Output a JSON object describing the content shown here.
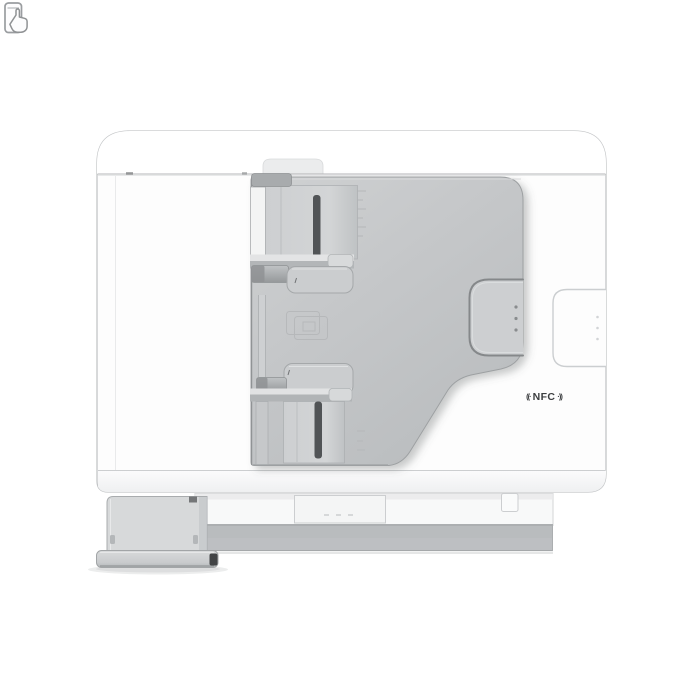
{
  "meta": {
    "description": "Product photo: white multifunction printer seen from above/rear, with gray automatic document feeder, paper guide rails, NFC tap zone, output tray and left hinge foot",
    "background": "#ffffff"
  },
  "labels": {
    "nfc_wave_left": "((·",
    "nfc": "NFC",
    "nfc_wave_right": "·))"
  },
  "icons": {
    "nfc_phone_tap": "smartphone outline with tapping hand",
    "paper_emboss": "embossed overlapping-pages glyph on ADF panel"
  },
  "colors": {
    "background": "#ffffff",
    "body": "#fdfdfd",
    "body_outline": "#c3c5c7",
    "adf_panel_edge": "#9da0a2",
    "slot_dark": "#515456",
    "tab": "#a8abad",
    "handle_outline": "#85888a",
    "base_band": "#b9bcbe",
    "hinge_panel": "#d7d9da",
    "nfc_text": "#3c3e40"
  }
}
